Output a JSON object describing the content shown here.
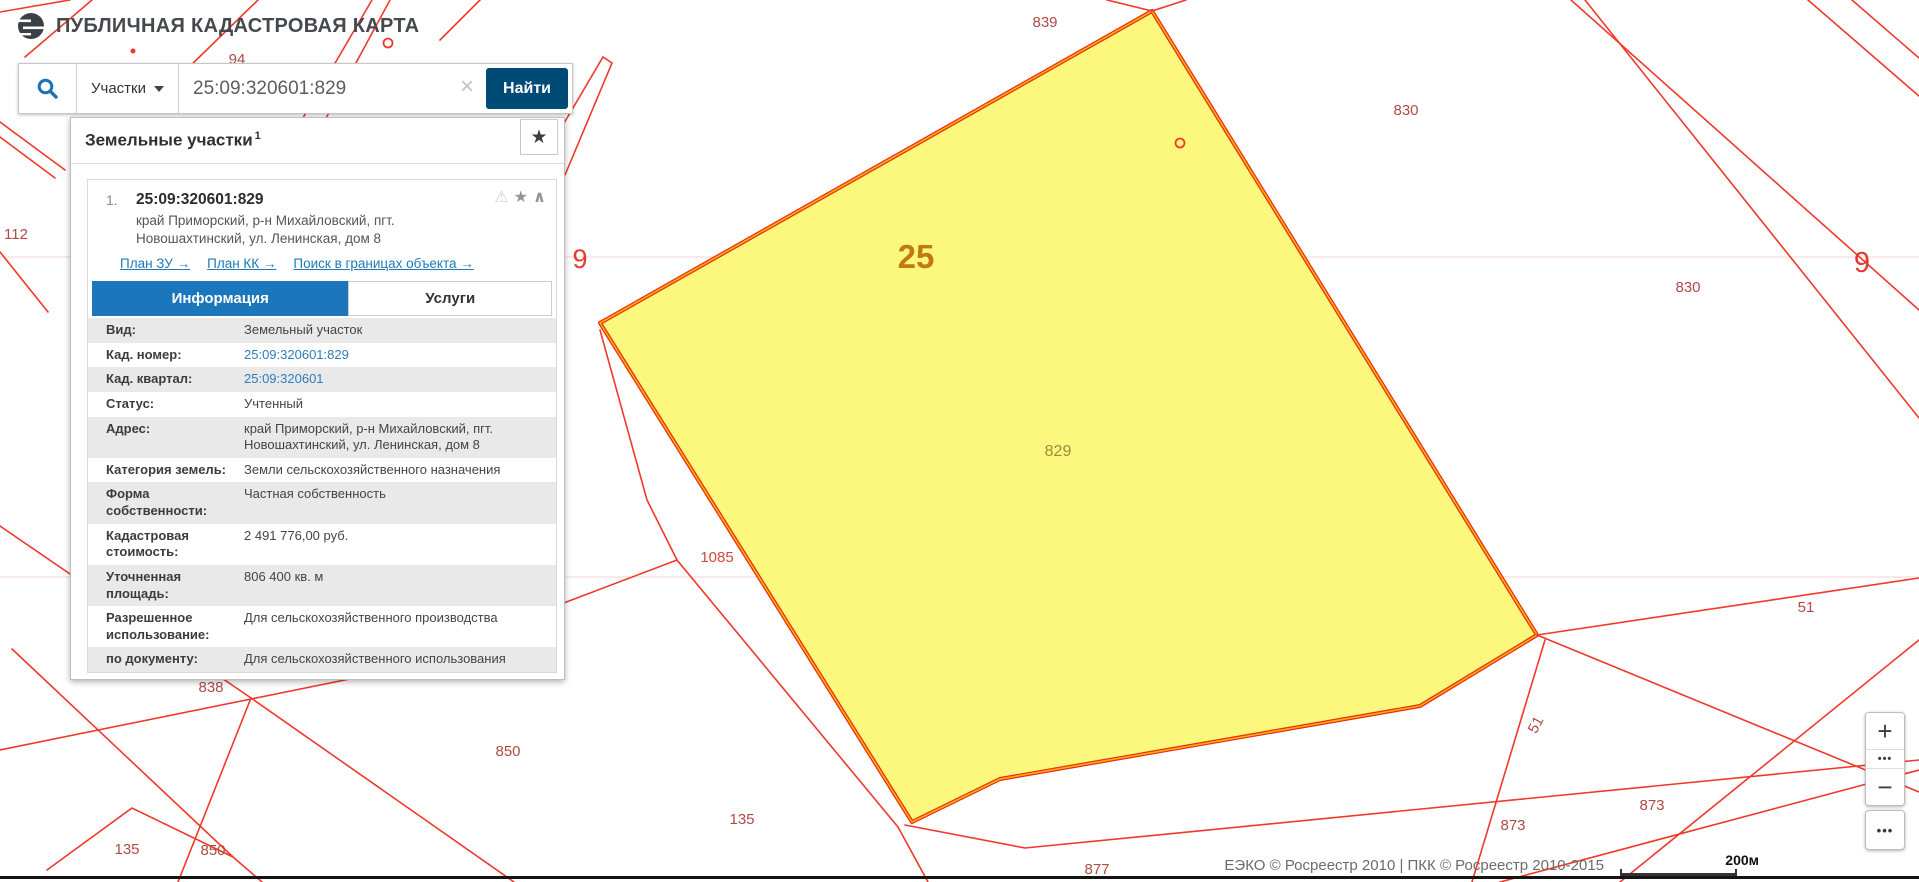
{
  "header": {
    "title": "ПУБЛИЧНАЯ КАДАСТРОВАЯ КАРТА"
  },
  "search": {
    "category_label": "Участки",
    "query": "25:09:320601:829",
    "clear_label": "×",
    "submit_label": "Найти"
  },
  "results_panel": {
    "title": "Земельные участки",
    "count_superscript": "1",
    "result": {
      "index": "1.",
      "cadastral_number": "25:09:320601:829",
      "address": "край Приморский, р-н Михайловский, пгт. Новошахтинский, ул. Ленинская, дом 8",
      "icons": {
        "warning": "⚠",
        "favorite": "★",
        "collapse": "∧"
      },
      "links": [
        {
          "label": "План ЗУ →"
        },
        {
          "label": "План КК →"
        },
        {
          "label": "Поиск в границах объекта →"
        }
      ],
      "tabs": [
        {
          "label": "Информация",
          "active": true
        },
        {
          "label": "Услуги",
          "active": false
        }
      ],
      "info_rows": [
        {
          "label": "Вид:",
          "value": "Земельный участок"
        },
        {
          "label": "Кад. номер:",
          "value": "25:09:320601:829",
          "link": true
        },
        {
          "label": "Кад. квартал:",
          "value": "25:09:320601",
          "link": true
        },
        {
          "label": "Статус:",
          "value": "Учтенный"
        },
        {
          "label": "Адрес:",
          "value": "край Приморский, р-н Михайловский, пгт. Новошахтинский, ул. Ленинская, дом 8"
        },
        {
          "label": "Категория земель:",
          "value": "Земли сельскохозяйственного назначения"
        },
        {
          "label": "Форма собственности:",
          "value": "Частная собственность"
        },
        {
          "label": "Кадастровая стоимость:",
          "value": "2 491 776,00 руб."
        },
        {
          "label": "Уточненная площадь:",
          "value": "806 400 кв. м"
        },
        {
          "label": "Разрешенное использование:",
          "value": "Для сельскохозяйственного производства"
        },
        {
          "label": "по документу:",
          "value": "Для сельскохозяйственного использования"
        }
      ]
    }
  },
  "map": {
    "selected_parcel_number": "25",
    "selected_fill": "#fcf87d",
    "line_color": "#f0382b",
    "labels": [
      {
        "text": "94",
        "x": 237,
        "y": 64,
        "size": 15,
        "color": "#b04a45"
      },
      {
        "text": "839",
        "x": 1045,
        "y": 27,
        "size": 15,
        "color": "#b04a45"
      },
      {
        "text": "830",
        "x": 1406,
        "y": 115,
        "size": 15,
        "color": "#b04a45"
      },
      {
        "text": "830",
        "x": 1688,
        "y": 292,
        "size": 15,
        "color": "#b04a45"
      },
      {
        "text": "9",
        "x": 580,
        "y": 268,
        "size": 27,
        "color": "#e23a2c"
      },
      {
        "text": "25",
        "x": 916,
        "y": 268,
        "size": 33,
        "color": "#c2790f",
        "bold": true
      },
      {
        "text": "9",
        "x": 1862,
        "y": 272,
        "size": 29,
        "color": "#e23a2c"
      },
      {
        "text": "829",
        "x": 1058,
        "y": 456,
        "size": 16,
        "color": "#9d8a3a"
      },
      {
        "text": "112",
        "x": 16,
        "y": 239,
        "size": 15,
        "color": "#b04a45"
      },
      {
        "text": "1085",
        "x": 717,
        "y": 562,
        "size": 15,
        "color": "#d0473c"
      },
      {
        "text": "51",
        "x": 1806,
        "y": 612,
        "size": 15,
        "color": "#b04a45"
      },
      {
        "text": "51",
        "x": 1540,
        "y": 727,
        "size": 15,
        "color": "#b04a45",
        "rotate": -62
      },
      {
        "text": "838",
        "x": 211,
        "y": 692,
        "size": 15,
        "color": "#b04a45"
      },
      {
        "text": "850",
        "x": 508,
        "y": 756,
        "size": 15,
        "color": "#b04a45"
      },
      {
        "text": "135",
        "x": 127,
        "y": 854,
        "size": 15,
        "color": "#b04a45"
      },
      {
        "text": "850",
        "x": 213,
        "y": 855,
        "size": 15,
        "color": "#b04a45"
      },
      {
        "text": "135",
        "x": 742,
        "y": 824,
        "size": 15,
        "color": "#b04a45"
      },
      {
        "text": "877",
        "x": 1097,
        "y": 874,
        "size": 15,
        "color": "#b04a45"
      },
      {
        "text": "873",
        "x": 1513,
        "y": 830,
        "size": 15,
        "color": "#b04a45"
      },
      {
        "text": "873",
        "x": 1652,
        "y": 810,
        "size": 15,
        "color": "#b04a45"
      }
    ]
  },
  "controls": {
    "zoom_in_label": "+",
    "zoom_out_label": "−",
    "basemap_dots": "•••",
    "tools_dots": "•••"
  },
  "attribution": {
    "text": "ЕЭКО © Росреестр 2010 | ПКК © Росреестр 2010-2015",
    "scale_label": "200м"
  }
}
